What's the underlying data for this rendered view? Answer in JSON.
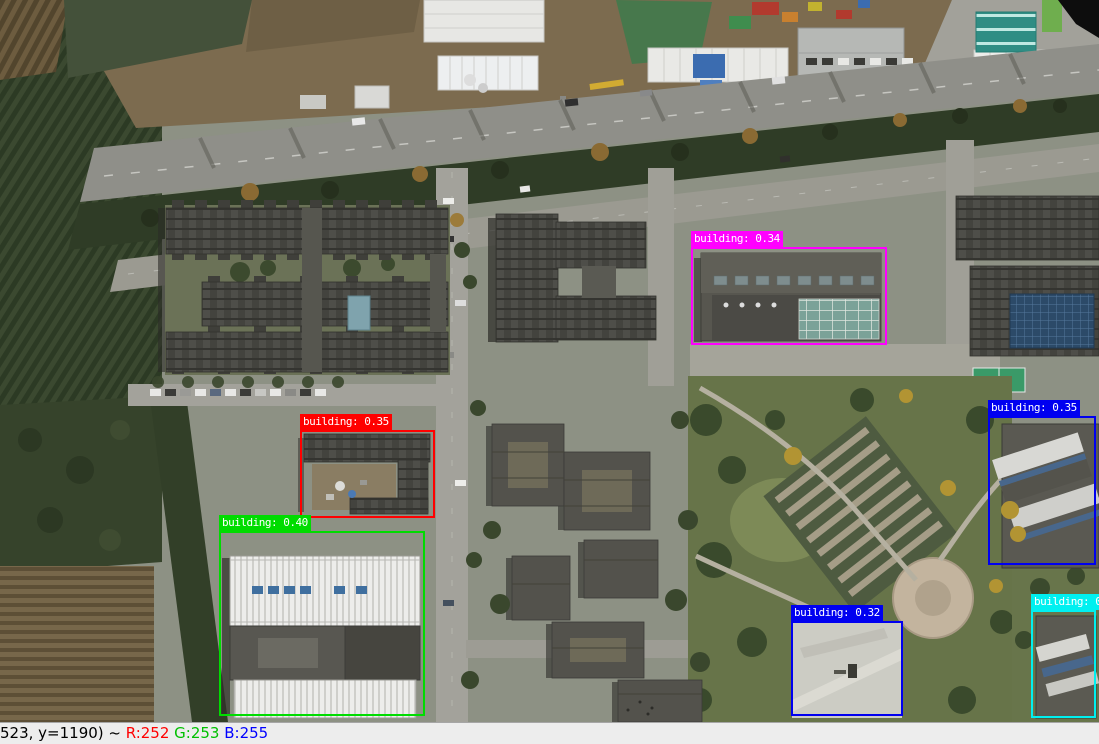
{
  "detections": [
    {
      "class": "building",
      "score": 0.34,
      "label": "building: 0.34",
      "color": "#ff00ff",
      "box": {
        "x": 691,
        "y": 247,
        "w": 196,
        "h": 98
      }
    },
    {
      "class": "building",
      "score": 0.35,
      "label": "building: 0.35",
      "color": "#ff0000",
      "box": {
        "x": 300,
        "y": 430,
        "w": 135,
        "h": 88
      }
    },
    {
      "class": "building",
      "score": 0.4,
      "label": "building: 0.40",
      "color": "#00dc00",
      "box": {
        "x": 219,
        "y": 531,
        "w": 206,
        "h": 185
      }
    },
    {
      "class": "building",
      "score": 0.35,
      "label": "building: 0.35",
      "color": "#0000f0",
      "box": {
        "x": 988,
        "y": 416,
        "w": 108,
        "h": 149
      }
    },
    {
      "class": "building",
      "score": 0.32,
      "label": "building: 0.32",
      "color": "#0000f0",
      "box": {
        "x": 791,
        "y": 621,
        "w": 112,
        "h": 95
      }
    },
    {
      "class": "building",
      "score": 0.33,
      "label": "building: 0.33",
      "color": "#00f0f0",
      "box": {
        "x": 1031,
        "y": 610,
        "w": 65,
        "h": 108
      }
    }
  ],
  "status_bar": {
    "segments": [
      {
        "name": "cursor-position",
        "text": "523, y=1190) ~ ",
        "color": "#000000"
      },
      {
        "name": "pixel-red-value",
        "text": "R:252 ",
        "color": "#ff0000"
      },
      {
        "name": "pixel-green-value",
        "text": "G:253 ",
        "color": "#00c000"
      },
      {
        "name": "pixel-blue-value",
        "text": "B:255",
        "color": "#0000ff"
      }
    ]
  }
}
